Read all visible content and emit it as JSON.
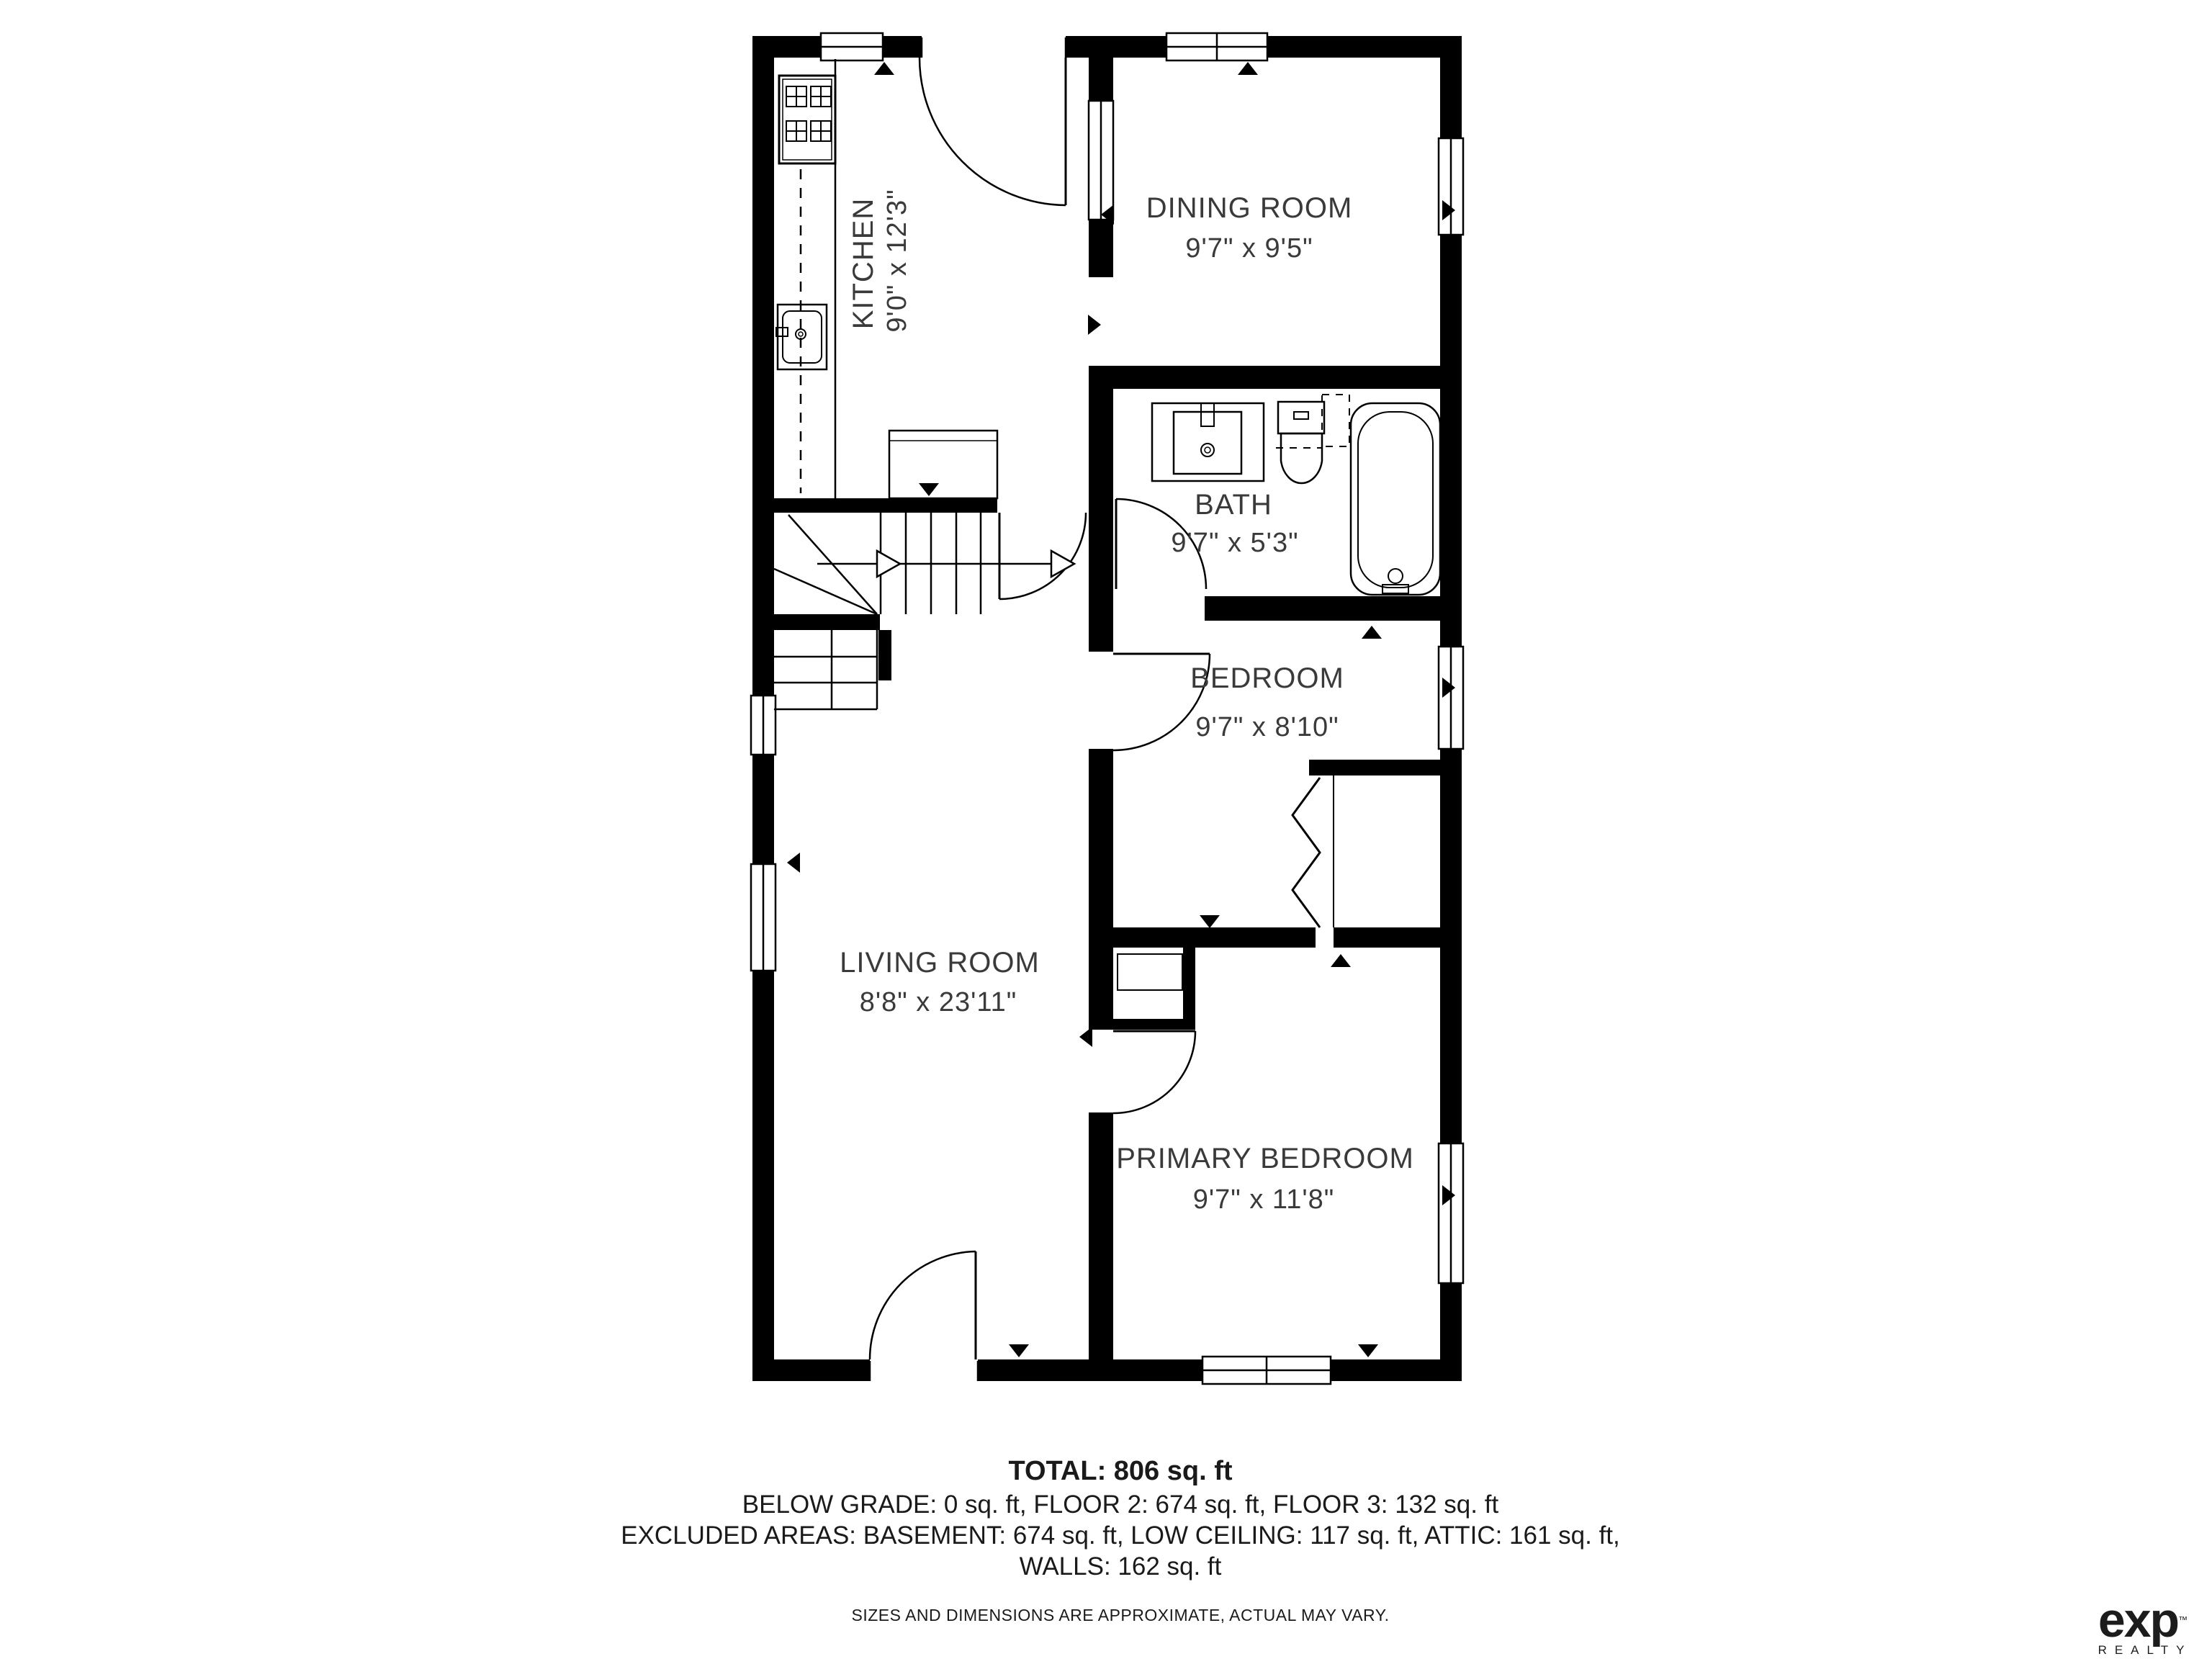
{
  "plan": {
    "rooms": [
      {
        "id": "kitchen",
        "name": "KITCHEN",
        "dims": "9'0\" x 12'3\""
      },
      {
        "id": "dining-room",
        "name": "DINING ROOM",
        "dims": "9'7\" x 9'5\""
      },
      {
        "id": "bath",
        "name": "BATH",
        "dims": "9'7\" x 5'3\""
      },
      {
        "id": "bedroom",
        "name": "BEDROOM",
        "dims": "9'7\" x 8'10\""
      },
      {
        "id": "living-room",
        "name": "LIVING ROOM",
        "dims": "8'8\" x 23'11\""
      },
      {
        "id": "primary-bedroom",
        "name": "PRIMARY BEDROOM",
        "dims": "9'7\" x 11'8\""
      }
    ]
  },
  "summary": {
    "total": "TOTAL: 806 sq. ft",
    "line2": "BELOW GRADE: 0 sq. ft, FLOOR 2: 674 sq. ft, FLOOR 3: 132 sq. ft",
    "line3": "EXCLUDED AREAS: BASEMENT: 674 sq. ft, LOW CEILING: 117 sq. ft, ATTIC: 161 sq. ft,",
    "line4": "WALLS: 162 sq. ft",
    "disclaimer": "SIZES AND DIMENSIONS ARE APPROXIMATE, ACTUAL MAY VARY."
  },
  "brand": {
    "name": "exp",
    "tm": "™",
    "sub": "REALTY"
  },
  "colors": {
    "wall": "#000000",
    "text": "#3a3a3a",
    "background": "#ffffff"
  }
}
